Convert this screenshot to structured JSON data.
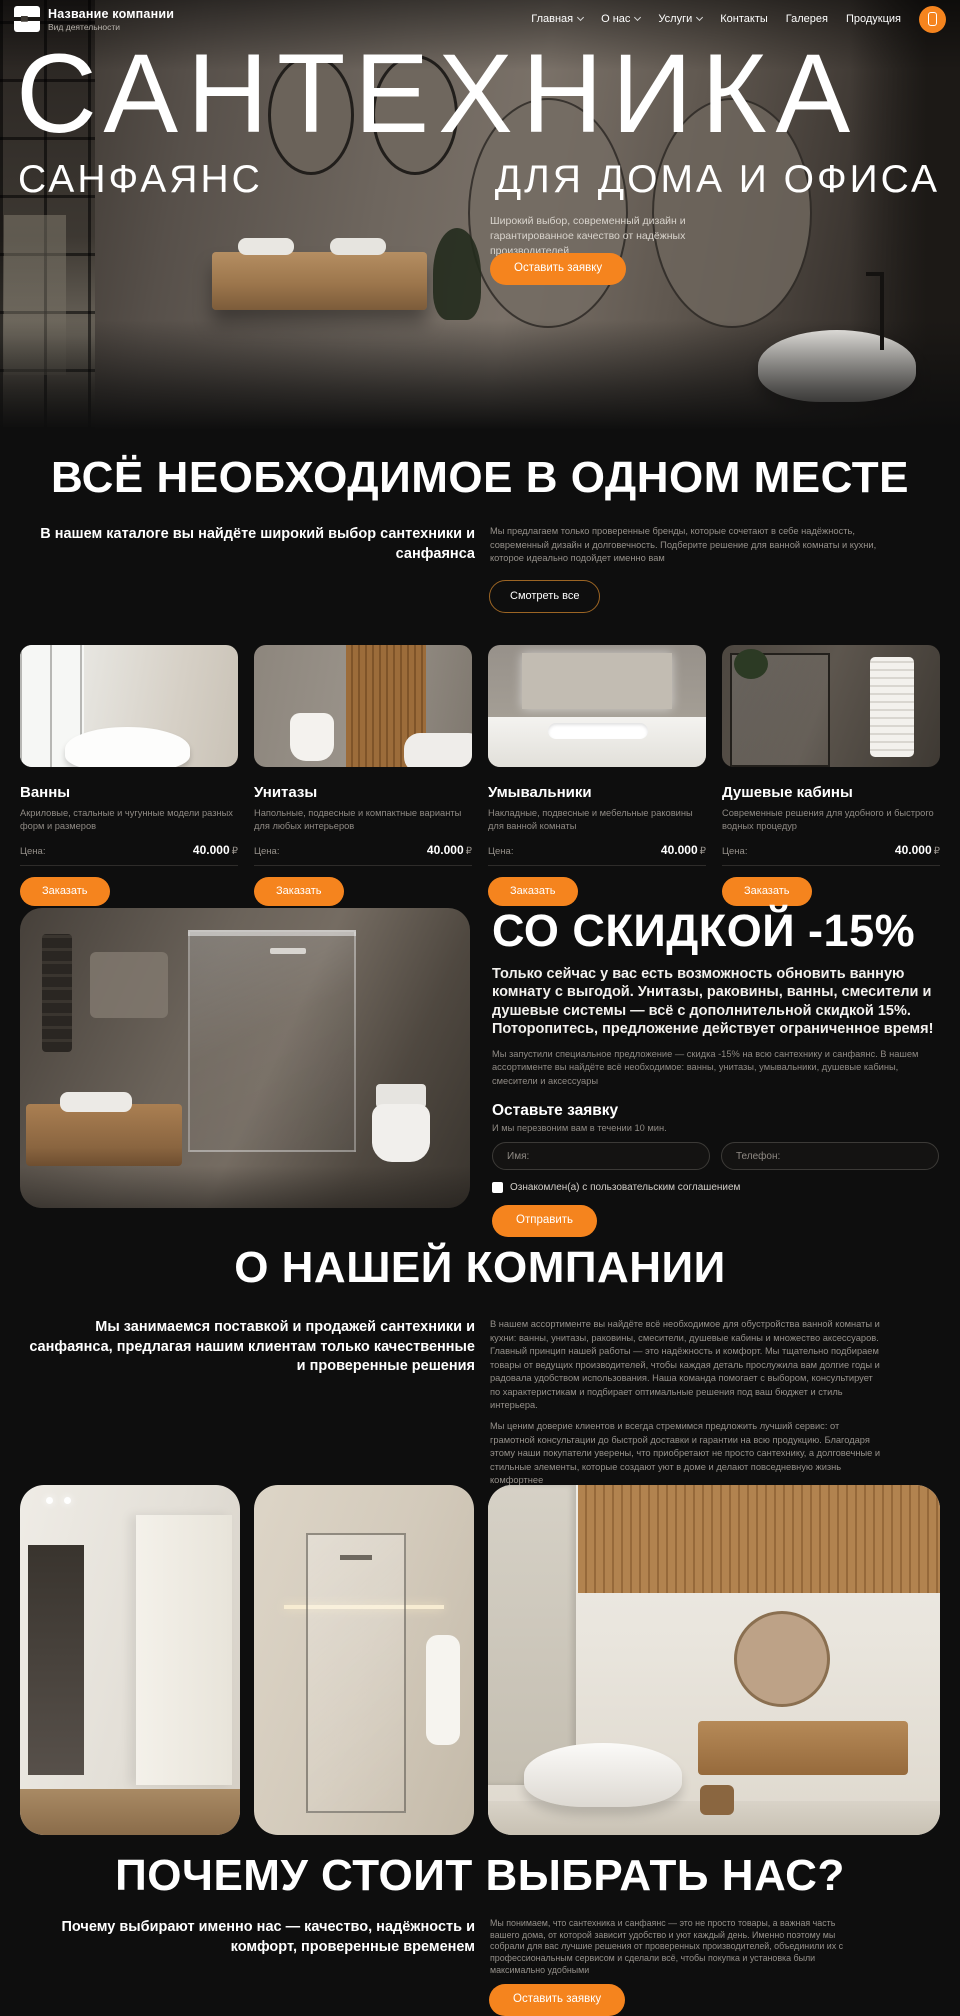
{
  "theme": {
    "accent": "#F5841E",
    "background": "#0E0E0E",
    "muted_text": "#95908A"
  },
  "header": {
    "company_name": "Название компании",
    "company_tagline": "Вид деятельности",
    "nav": [
      {
        "label": "Главная",
        "dropdown": true
      },
      {
        "label": "О нас",
        "dropdown": true
      },
      {
        "label": "Услуги",
        "dropdown": true
      },
      {
        "label": "Контакты",
        "dropdown": false
      },
      {
        "label": "Галерея",
        "dropdown": false
      },
      {
        "label": "Продукция",
        "dropdown": false
      }
    ],
    "phone_button_icon": "phone-icon"
  },
  "hero": {
    "title": "САНТЕХНИКА",
    "subtitle_left": "САНФАЯНС",
    "subtitle_right": "ДЛЯ ДОМА И ОФИСА",
    "description": "Широкий выбор, современный дизайн и гарантированное качество от надёжных производителей",
    "cta_label": "Оставить заявку"
  },
  "catalog": {
    "title": "ВСЁ НЕОБХОДИМОЕ В ОДНОМ МЕСТЕ",
    "lead": "В нашем каталоге вы найдёте широкий выбор сантехники и санфаянса",
    "description": "Мы предлагаем только проверенные бренды, которые сочетают в себе надёжность, современный дизайн и долговечность. Подберите решение для ванной комнаты и кухни, которое идеально подойдет именно вам",
    "view_all_label": "Смотреть все",
    "price_label": "Цена:",
    "order_label": "Заказать",
    "products": [
      {
        "name": "Ванны",
        "description": "Акриловые, стальные и чугунные модели разных форм и размеров",
        "price": "40.000",
        "currency": "₽"
      },
      {
        "name": "Унитазы",
        "description": "Напольные, подвесные и компактные варианты для любых интерьеров",
        "price": "40.000",
        "currency": "₽"
      },
      {
        "name": "Умывальники",
        "description": "Накладные, подвесные и мебельные раковины для ванной комнаты",
        "price": "40.000",
        "currency": "₽"
      },
      {
        "name": "Душевые кабины",
        "description": "Современные решения для удобного и быстрого водных процедур",
        "price": "40.000",
        "currency": "₽"
      }
    ]
  },
  "discount": {
    "title": "СО СКИДКОЙ -15%",
    "subtitle": "Только сейчас у вас есть возможность обновить ванную комнату с выгодой. Унитазы, раковины, ванны, смесители и душевые системы — всё с дополнительной скидкой 15%. Поторопитесь, предложение действует ограниченное время!",
    "note": "Мы запустили специальное предложение — скидка -15% на всю сантехнику и санфаянс. В нашем ассортименте вы найдёте всё необходимое: ванны, унитазы, умывальники, душевые кабины, смесители и аксессуары",
    "form": {
      "title": "Оставьте заявку",
      "subtitle": "И мы перезвоним вам в течении 10 мин.",
      "name_placeholder": "Имя:",
      "phone_placeholder": "Телефон:",
      "consent_label": "Ознакомлен(а) с пользовательским соглашением",
      "submit_label": "Отправить"
    }
  },
  "about": {
    "title": "О НАШЕЙ КОМПАНИИ",
    "lead": "Мы занимаемся поставкой и продажей сантехники и санфаянса, предлагая нашим клиентам только качественные и проверенные решения",
    "paragraph1": "В нашем ассортименте вы найдёте всё необходимое для обустройства ванной комнаты и кухни: ванны, унитазы, раковины, смесители, душевые кабины и множество аксессуаров. Главный принцип нашей работы — это надёжность и комфорт. Мы тщательно подбираем товары от ведущих производителей, чтобы каждая деталь прослужила вам долгие годы и радовала удобством использования. Наша команда помогает с выбором, консультирует по характеристикам и подбирает оптимальные решения под ваш бюджет и стиль интерьера.",
    "paragraph2": "Мы ценим доверие клиентов и всегда стремимся предложить лучший сервис: от грамотной консультации до быстрой доставки и гарантии на всю продукцию. Благодаря этому наши покупатели уверены, что приобретают не просто сантехнику, а долговечные и стильные элементы, которые создают уют в доме и делают повседневную жизнь комфортнее",
    "more_label": "Узнать подробнее"
  },
  "why": {
    "title": "ПОЧЕМУ СТОИТ ВЫБРАТЬ НАС?",
    "lead": "Почему выбирают именно нас — качество, надёжность и комфорт, проверенные временем",
    "description": "Мы понимаем, что сантехника и санфаянс — это не просто товары, а важная часть вашего дома, от которой зависит удобство и уют каждый день. Именно поэтому мы собрали для вас лучшие решения от проверенных производителей, объединили их с профессиональным сервисом и сделали всё, чтобы покупка и установка были максимально удобными",
    "cta_label": "Оставить заявку"
  }
}
